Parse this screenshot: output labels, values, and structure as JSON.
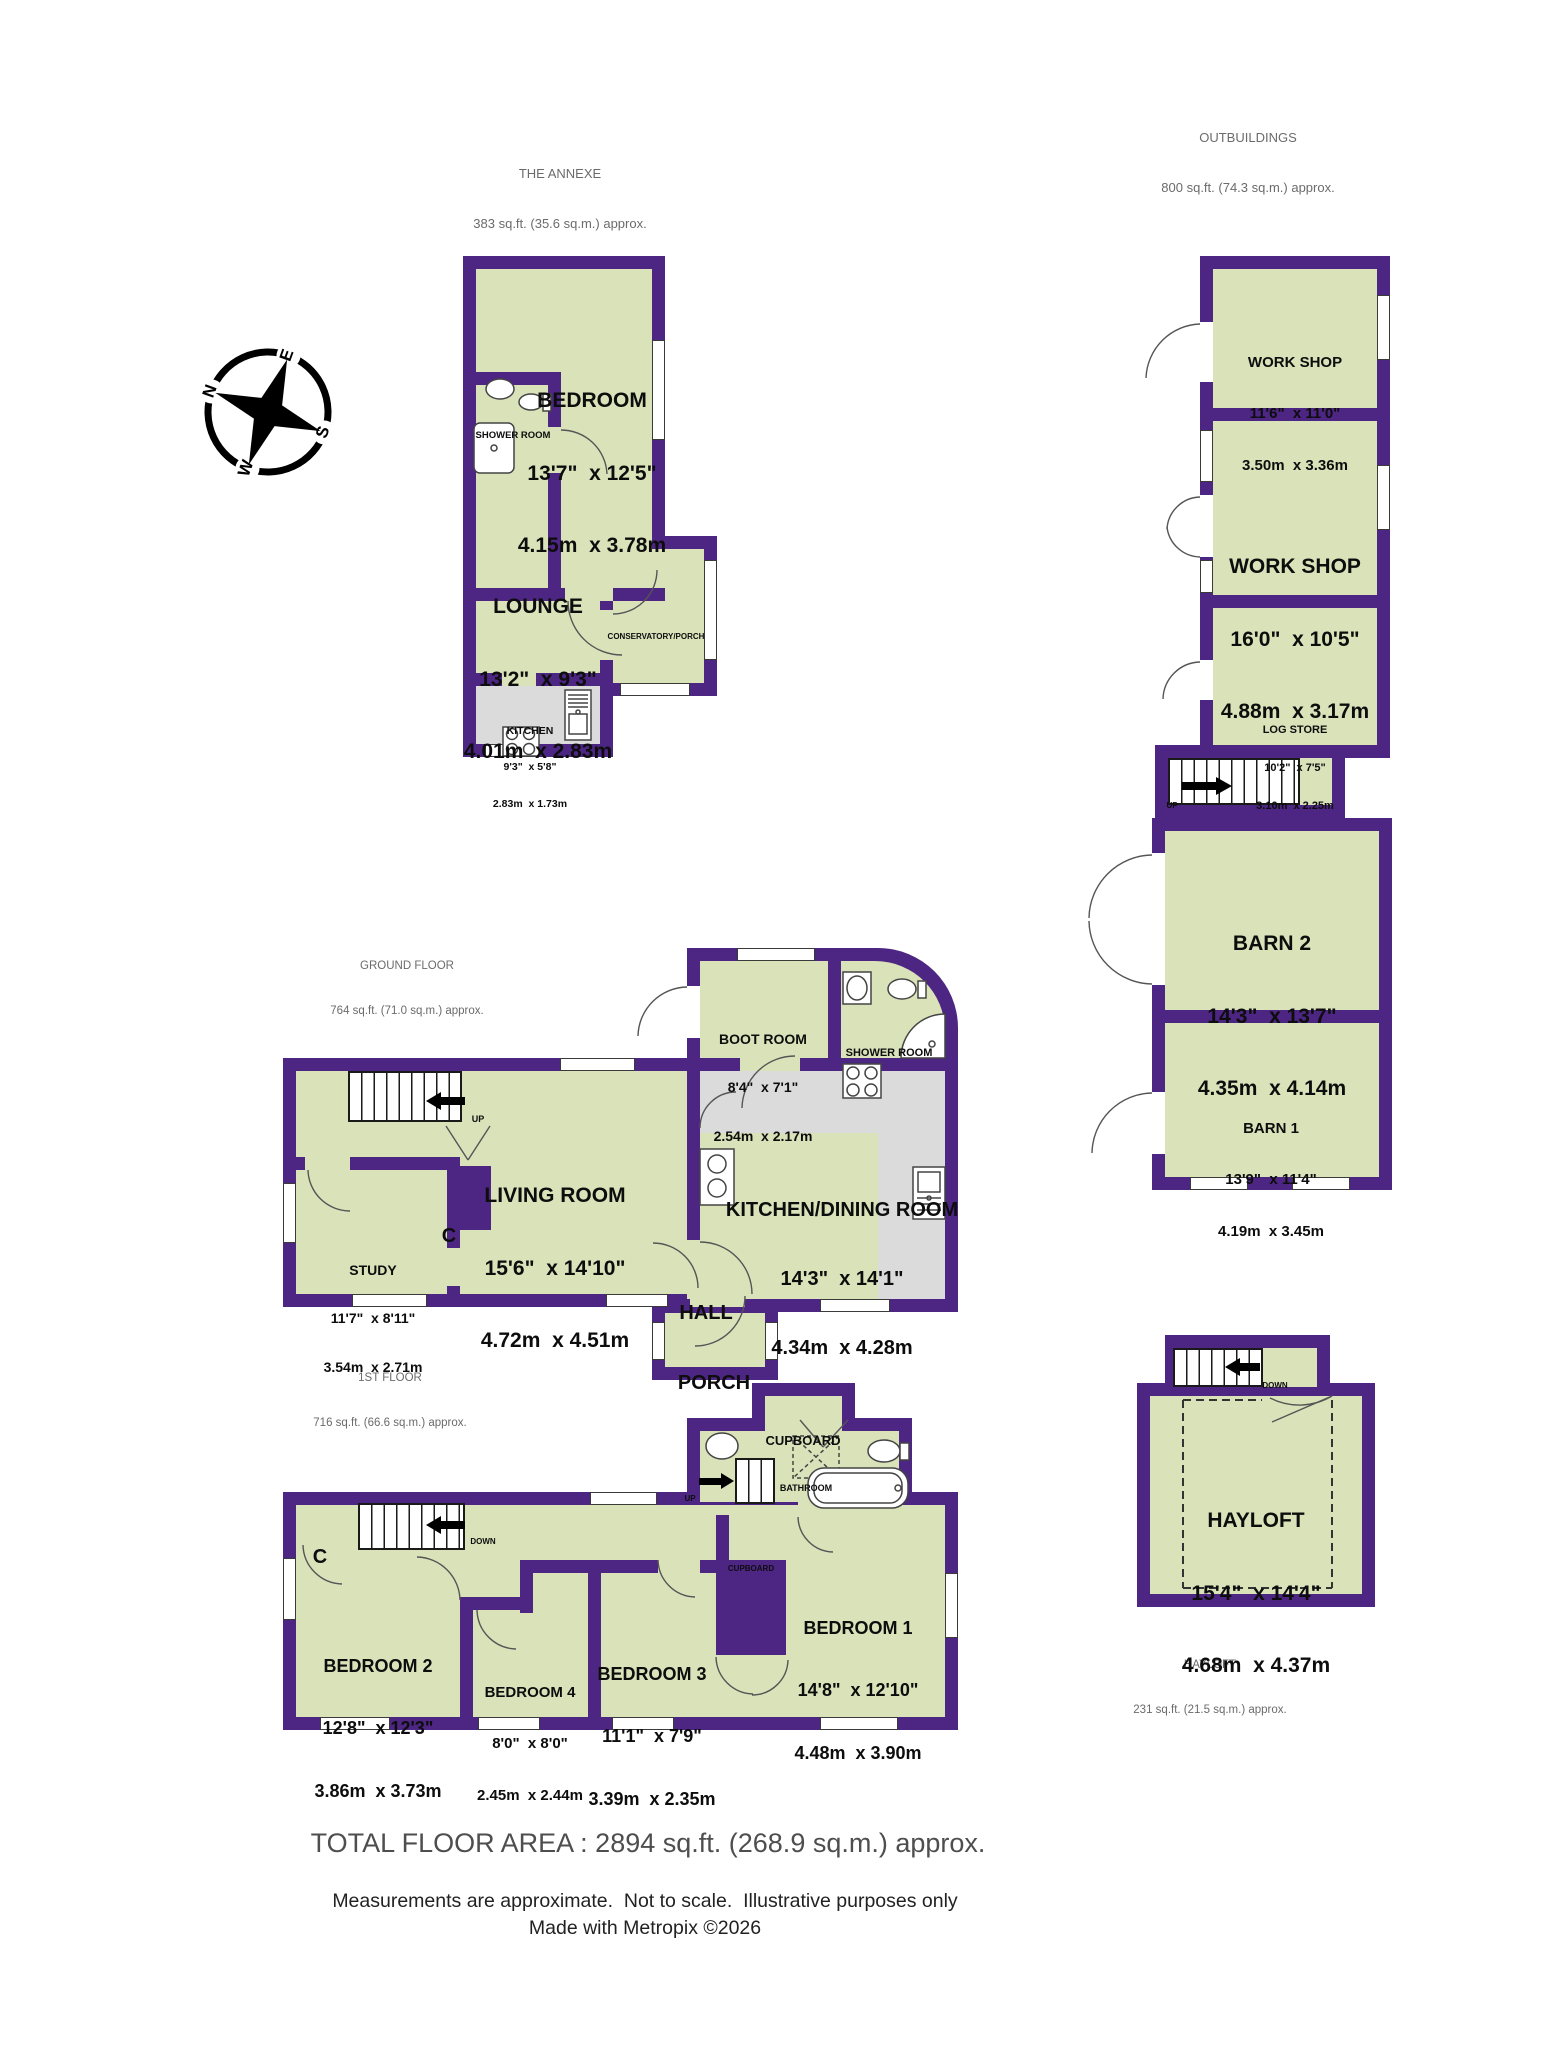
{
  "footer": {
    "total": "TOTAL FLOOR AREA : 2894 sq.ft. (268.9 sq.m.) approx.",
    "disclaimer": "Measurements are approximate.  Not to scale.  Illustrative purposes only",
    "credit": "Made with Metropix ©2026"
  },
  "colors": {
    "wall": "#4D2583",
    "room_fill": "#DAE2BA",
    "floor_gray": "#DBDBDB"
  },
  "compass": {
    "n": "N",
    "e": "E",
    "s": "S",
    "w": "W"
  },
  "sections": {
    "annexe": {
      "title": "THE ANNEXE",
      "area": "383 sq.ft. (35.6 sq.m.) approx."
    },
    "outbuildings": {
      "title": "OUTBUILDINGS",
      "area": "800 sq.ft. (74.3 sq.m.) approx."
    },
    "ground_floor": {
      "title": "GROUND FLOOR",
      "area": "764 sq.ft. (71.0 sq.m.) approx."
    },
    "first_floor": {
      "title": "1ST FLOOR",
      "area": "716 sq.ft. (66.6 sq.m.) approx."
    },
    "hayloft_caption": {
      "title": "HAYLOFT",
      "area": "231 sq.ft. (21.5 sq.m.) approx."
    }
  },
  "rooms": {
    "annexe_bedroom": {
      "name": "BEDROOM",
      "imperial": "13'7\"  x 12'5\"",
      "metric": "4.15m  x 3.78m"
    },
    "annexe_shower": {
      "name": "SHOWER ROOM"
    },
    "annexe_lounge": {
      "name": "LOUNGE",
      "imperial": "13'2\"  x 9'3\"",
      "metric": "4.01m  x 2.83m"
    },
    "annexe_kitchen": {
      "name": "KITCHEN",
      "imperial": "9'3\"  x 5'8\"",
      "metric": "2.83m  x 1.73m"
    },
    "conservatory": {
      "name": "CONSERVATORY/PORCH"
    },
    "workshop1": {
      "name": "WORK SHOP",
      "imperial": "11'6\"  x 11'0\"",
      "metric": "3.50m  x 3.36m"
    },
    "workshop2": {
      "name": "WORK SHOP",
      "imperial": "16'0\"  x 10'5\"",
      "metric": "4.88m  x 3.17m"
    },
    "log_store": {
      "name": "LOG STORE",
      "imperial": "10'2\"  x 7'5\"",
      "metric": "3.10m  x 2.25m"
    },
    "barn2": {
      "name": "BARN 2",
      "imperial": "14'3\"  x 13'7\"",
      "metric": "4.35m  x 4.14m"
    },
    "barn1": {
      "name": "BARN 1",
      "imperial": "13'9\"  x 11'4\"",
      "metric": "4.19m  x 3.45m"
    },
    "living_room": {
      "name": "LIVING ROOM",
      "imperial": "15'6\"  x 14'10\"",
      "metric": "4.72m  x 4.51m"
    },
    "study": {
      "name": "STUDY",
      "imperial": "11'7\"  x 8'11\"",
      "metric": "3.54m  x 2.71m"
    },
    "kitchen_dining": {
      "name": "KITCHEN/DINING ROOM",
      "imperial": "14'3\"  x 14'1\"",
      "metric": "4.34m  x 4.28m"
    },
    "boot_room": {
      "name": "BOOT ROOM",
      "imperial": "8'4\"  x 7'1\"",
      "metric": "2.54m  x 2.17m"
    },
    "gf_shower": {
      "name": "SHOWER ROOM"
    },
    "hall": {
      "name": "HALL"
    },
    "porch": {
      "name": "PORCH"
    },
    "bathroom": {
      "name": "BATHROOM"
    },
    "bedroom1": {
      "name": "BEDROOM 1",
      "imperial": "14'8\"  x 12'10\"",
      "metric": "4.48m  x 3.90m"
    },
    "bedroom2": {
      "name": "BEDROOM 2",
      "imperial": "12'8\"  x 12'3\"",
      "metric": "3.86m  x 3.73m"
    },
    "bedroom3": {
      "name": "BEDROOM 3",
      "imperial": "11'1\"  x 7'9\"",
      "metric": "3.39m  x 2.35m"
    },
    "bedroom4": {
      "name": "BEDROOM 4",
      "imperial": "8'0\"  x 8'0\"",
      "metric": "2.45m  x 2.44m"
    },
    "hayloft": {
      "name": "HAYLOFT",
      "imperial": "15'4\"  x 14'4\"",
      "metric": "4.68m  x 4.37m"
    }
  },
  "stairs": {
    "up": "UP",
    "down": "DOWN"
  },
  "cupboard": {
    "c": "C",
    "label": "CUPBOARD"
  }
}
